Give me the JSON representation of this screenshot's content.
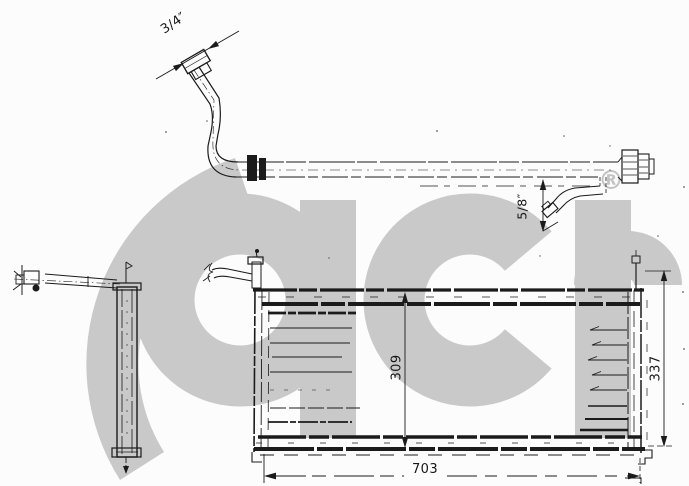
{
  "watermark": {
    "brand_text": "acr",
    "registered_symbol": "®",
    "color": "#c9c9c9"
  },
  "drawing": {
    "background_color": "#fcfcfc",
    "line_color": "#1b1b1b"
  },
  "dimensions": {
    "hose_fitting_large": "3/4″",
    "hose_fitting_small": "5/8″",
    "core_height": "309",
    "overall_height": "337",
    "overall_width": "703"
  }
}
